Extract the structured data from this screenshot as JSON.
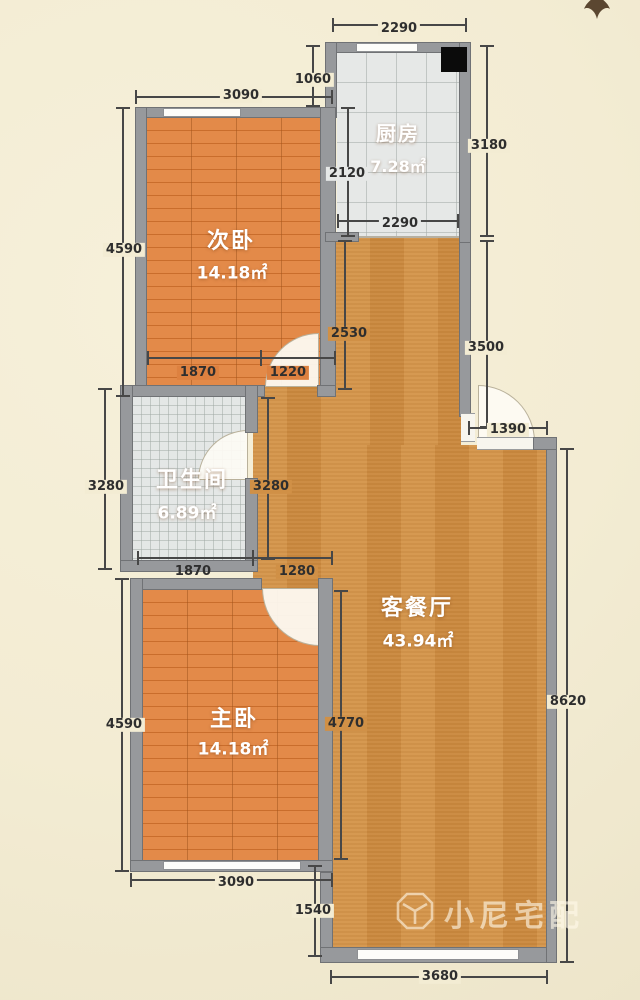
{
  "rooms": {
    "kitchen": {
      "name": "厨房",
      "area": "7.28㎡"
    },
    "second_bedroom": {
      "name": "次卧",
      "area": "14.18㎡"
    },
    "bathroom": {
      "name": "卫生间",
      "area": "6.89㎡"
    },
    "master_bedroom": {
      "name": "主卧",
      "area": "14.18㎡"
    },
    "living_dining": {
      "name": "客餐厅",
      "area": "43.94㎡"
    }
  },
  "dims": {
    "kitchen_top": "2290",
    "kitchen_offset": "1060",
    "bedroom2_top": "3090",
    "kitchen_right": "3180",
    "kitchen_inner_height": "2120",
    "kitchen_bottom": "2290",
    "bedroom2_left": "4590",
    "corridor_upper": "2530",
    "entry_wall_upper": "3500",
    "bedroom2_bottom_left": "1870",
    "bedroom2_bottom_right": "1220",
    "entry_width": "1390",
    "bathroom_left": "3280",
    "corridor_mid": "3280",
    "bathroom_bottom": "1870",
    "corridor_bottom": "1280",
    "master_left": "4590",
    "master_inner_right": "4770",
    "living_right": "8620",
    "master_bottom": "3090",
    "living_bottom_left": "1540",
    "living_bottom": "3680"
  },
  "watermark": {
    "text": "小尼宅配"
  },
  "colors": {
    "background": "#f3ecd3",
    "wall": "#97999c",
    "living_floor": "#d09046",
    "bedroom_floor": "#dd8140",
    "tile_floor": "#e6e8e7",
    "flue": "#0b0b0b",
    "dimension_text": "#2e2e2e"
  }
}
